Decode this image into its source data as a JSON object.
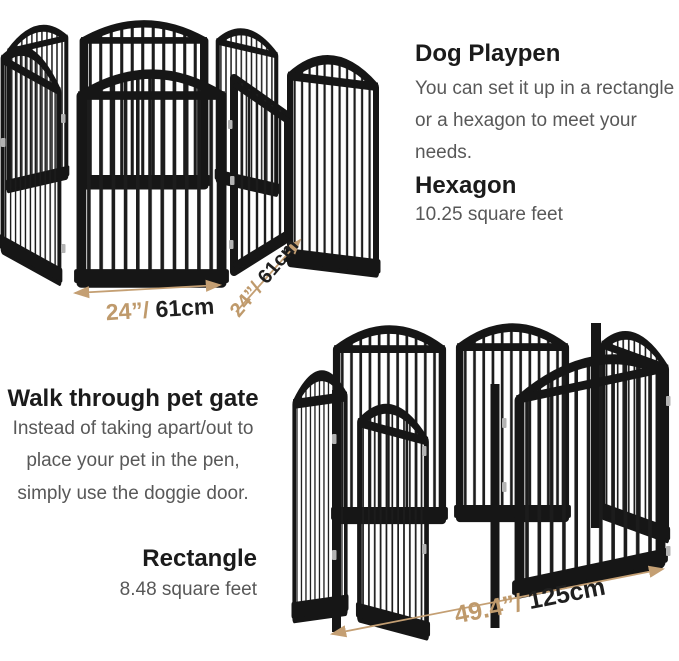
{
  "playpen_section": {
    "title": "Dog Playpen",
    "line1": "You can set it up in a rectangle",
    "line2": "or a hexagon to meet your",
    "line3": "needs.",
    "shape": "Hexagon",
    "area": "10.25 square feet"
  },
  "gate_section": {
    "title": "Walk through pet gate",
    "line1": "Instead of taking apart/out to",
    "line2": "place your pet in the pen,",
    "line3": "simply use the doggie door.",
    "shape": "Rectangle",
    "area": "8.48 square feet"
  },
  "dimensions": {
    "hexagon_panel_front": {
      "inches": "24”/",
      "cm": " 61cm"
    },
    "hexagon_panel_side": {
      "inches": "24”/",
      "cm": " 61cm"
    },
    "rectangle_width": {
      "inches": "49.4”/",
      "cm": " 125cm"
    }
  },
  "colors": {
    "accent_tan": "#bf9a6c",
    "heading_dark": "#1b1b1b",
    "body_gray": "#585858",
    "pen_black": "#161616"
  }
}
